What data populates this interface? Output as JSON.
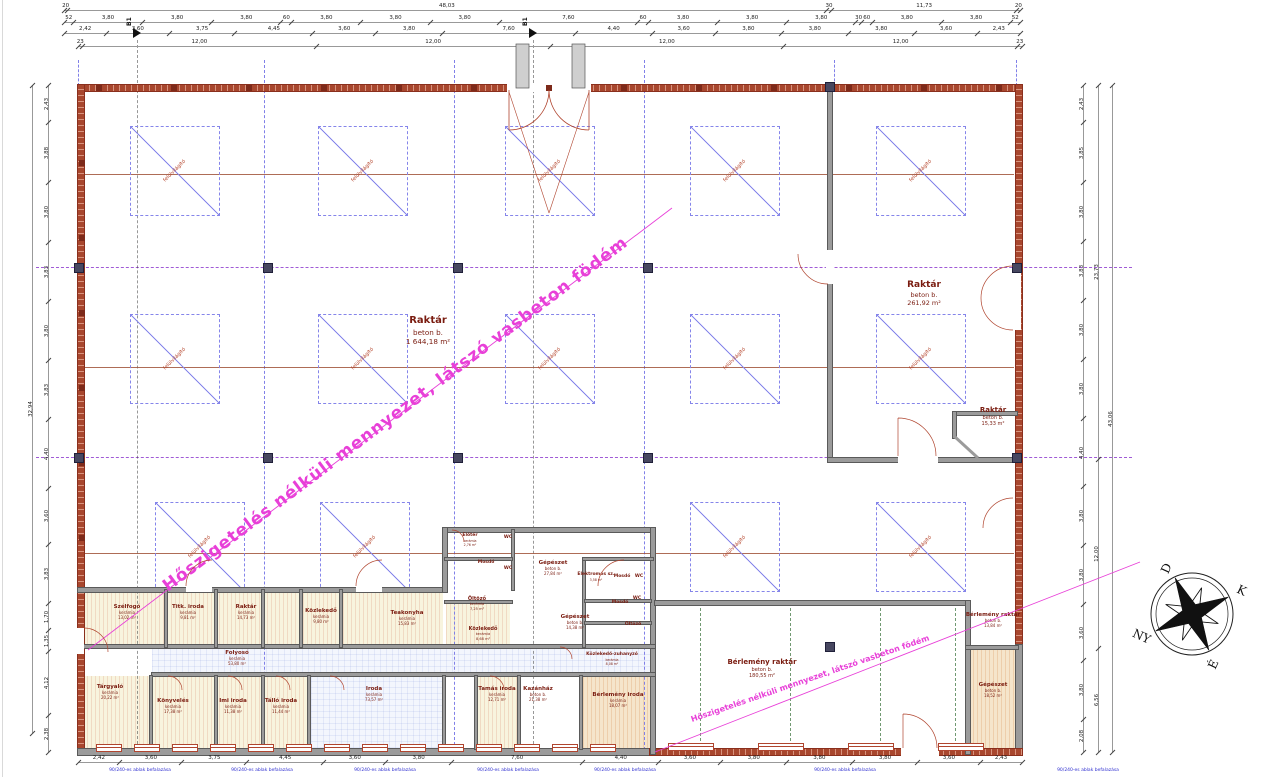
{
  "colors": {
    "wall_red": "#a8472e",
    "wall_gray": "#9b9b9b",
    "grid_blue": "#8080e8",
    "axis_purple": "#a05ad6",
    "beam_brown": "#a05238",
    "magenta_note": "#e83fd8",
    "room_label": "#7a1c10",
    "skylight_red": "#b5452c",
    "annotation_blue": "#2f2fd0"
  },
  "notes": {
    "ceiling_note": "Hőszigetelés nélküli mennyezet, látszó vasbeton födém",
    "ceiling_note_secondary": "Hőszigetelés nélküli mennyezet, látszó vasbeton födém"
  },
  "skylight_label": "felülvilágító",
  "section_markers": [
    "B1",
    "B1"
  ],
  "compass": {
    "d": "D",
    "k": "K",
    "e": "É",
    "ny": "NY"
  },
  "annotations": {
    "window_note": "90/240-es ablak befalazása"
  },
  "rooms": [
    {
      "n": "Raktár",
      "m": "beton b.",
      "a": "1 644,18 m²",
      "x": 428,
      "y": 315,
      "fs": 10
    },
    {
      "n": "Raktár",
      "m": "beton b.",
      "a": "261,92 m²",
      "x": 924,
      "y": 280,
      "fs": 9
    },
    {
      "n": "Raktár",
      "m": "beton b.",
      "a": "15,33 m²",
      "x": 993,
      "y": 406,
      "fs": 7
    },
    {
      "n": "Bérlemény raktár",
      "m": "beton b.",
      "a": "180,55 m²",
      "x": 762,
      "y": 658,
      "fs": 7
    },
    {
      "n": "Bérlemény raktár",
      "m": "beton b.",
      "a": "13,84 m²",
      "x": 993,
      "y": 612,
      "fs": 5.5
    },
    {
      "n": "Gépészet",
      "m": "beton b.",
      "a": "18,52 m²",
      "x": 993,
      "y": 682,
      "fs": 5.5
    },
    {
      "n": "Szélfogó",
      "m": "kerámia",
      "a": "13,02 m²",
      "x": 127,
      "y": 604,
      "fs": 5.5
    },
    {
      "n": "Titk. iroda",
      "m": "kerámia",
      "a": "9,81 m²",
      "x": 188,
      "y": 604,
      "fs": 5.5
    },
    {
      "n": "Raktár",
      "m": "kerámia",
      "a": "14,73 m²",
      "x": 246,
      "y": 604,
      "fs": 5.5
    },
    {
      "n": "Közlekedő",
      "m": "kerámia",
      "a": "9,80 m²",
      "x": 321,
      "y": 608,
      "fs": 5.5
    },
    {
      "n": "Teakonyha",
      "m": "kerámia",
      "a": "15,83 m²",
      "x": 407,
      "y": 610,
      "fs": 5.5
    },
    {
      "n": "Közlekedő",
      "m": "kerámia",
      "a": "8,68 m²",
      "x": 483,
      "y": 626,
      "fs": 5
    },
    {
      "n": "Gépészet",
      "m": "beton b.",
      "a": "27,84 m²",
      "x": 553,
      "y": 560,
      "fs": 5.5
    },
    {
      "n": "Elektromos sz.",
      "m": "",
      "a": "3,58 m²",
      "x": 596,
      "y": 572,
      "fs": 4.5
    },
    {
      "n": "Előtér",
      "m": "kerámia",
      "a": "2,76 m²",
      "x": 470,
      "y": 533,
      "fs": 4.5
    },
    {
      "n": "WC",
      "m": "",
      "a": "",
      "x": 508,
      "y": 535,
      "fs": 4.5
    },
    {
      "n": "Mosdó",
      "m": "",
      "a": "",
      "x": 486,
      "y": 560,
      "fs": 4.5
    },
    {
      "n": "WC",
      "m": "",
      "a": "",
      "x": 508,
      "y": 566,
      "fs": 4.5
    },
    {
      "n": "Öltöző",
      "m": "kerámia",
      "a": "7,25 m²",
      "x": 477,
      "y": 596,
      "fs": 5
    },
    {
      "n": "Mosdó",
      "m": "",
      "a": "",
      "x": 622,
      "y": 574,
      "fs": 4.5
    },
    {
      "n": "WC",
      "m": "",
      "a": "",
      "x": 639,
      "y": 574,
      "fs": 4.5
    },
    {
      "n": "Mosdó",
      "m": "",
      "a": "",
      "x": 620,
      "y": 600,
      "fs": 4.5
    },
    {
      "n": "WC",
      "m": "",
      "a": "",
      "x": 637,
      "y": 596,
      "fs": 4.5
    },
    {
      "n": "Öltöző",
      "m": "",
      "a": "",
      "x": 633,
      "y": 622,
      "fs": 4.5
    },
    {
      "n": "Gépészet",
      "m": "beton b.",
      "a": "14,38 m²",
      "x": 575,
      "y": 614,
      "fs": 5.5
    },
    {
      "n": "Folyosó",
      "m": "kerámia",
      "a": "53,80 m²",
      "x": 237,
      "y": 650,
      "fs": 5.5
    },
    {
      "n": "Tárgyaló",
      "m": "kerámia",
      "a": "20,22 m²",
      "x": 110,
      "y": 684,
      "fs": 5.5
    },
    {
      "n": "Könyvelés",
      "m": "kerámia",
      "a": "17,38 m²",
      "x": 173,
      "y": 698,
      "fs": 5.5
    },
    {
      "n": "Imi iroda",
      "m": "kerámia",
      "a": "11,38 m²",
      "x": 233,
      "y": 698,
      "fs": 5.5
    },
    {
      "n": "Tálló iroda",
      "m": "kerámia",
      "a": "11,44 m²",
      "x": 281,
      "y": 698,
      "fs": 5.5
    },
    {
      "n": "Iroda",
      "m": "kerámia",
      "a": "73,57 m²",
      "x": 374,
      "y": 686,
      "fs": 5.5
    },
    {
      "n": "Tamás iroda",
      "m": "kerámia",
      "a": "12,71 m²",
      "x": 497,
      "y": 686,
      "fs": 5.5
    },
    {
      "n": "Kazánház",
      "m": "beton b.",
      "a": "21,38 m²",
      "x": 538,
      "y": 686,
      "fs": 5.5
    },
    {
      "n": "Közlekedő-zuhanyzó",
      "m": "kerámia",
      "a": "8,08 m²",
      "x": 612,
      "y": 652,
      "fs": 4.5
    },
    {
      "n": "Bérlemény iroda",
      "m": "kerámia",
      "a": "18,07 m²",
      "x": 618,
      "y": 692,
      "fs": 5.5
    }
  ],
  "dimensions": {
    "top_total": [
      "20",
      "48,03",
      "30",
      "11,73",
      "20"
    ],
    "top_detail": [
      "52",
      "3,80",
      "3,80",
      "3,80",
      "60",
      "3,80",
      "3,80",
      "3,80",
      "7,60",
      "60",
      "3,80",
      "3,80",
      "3,80",
      "30",
      "60",
      "3,80",
      "3,80",
      "52"
    ],
    "top_inner": [
      "2,42",
      "3,60",
      "3,75",
      "4,45",
      "3,60",
      "3,80",
      "7,60",
      "4,40",
      "3,60",
      "3,80",
      "3,80",
      "3,80",
      "3,60",
      "2,43"
    ],
    "top_axes": [
      "23",
      "12,00",
      "12,00",
      "12,00",
      "12,00",
      "23"
    ],
    "left_outer": [
      "32,94"
    ],
    "left_detail": [
      "2,43",
      "3,88",
      "3,80",
      "3,83",
      "3,80",
      "3,83",
      "4,40",
      "3,60",
      "3,83",
      "1,70",
      "1,35",
      "4,12",
      "2,38"
    ],
    "right_detail": [
      "2,43",
      "3,85",
      "3,80",
      "3,83",
      "3,80",
      "3,80",
      "4,40",
      "3,80",
      "3,80",
      "3,60",
      "3,80",
      "2,08"
    ],
    "right_mid": [
      "23,73",
      "12,00",
      "6,56"
    ],
    "right_total": [
      "43,06"
    ],
    "bottom": [
      "2,42",
      "3,60",
      "3,75",
      "4,45",
      "3,60",
      "3,80",
      "7,60",
      "4,40",
      "3,60",
      "3,80",
      "3,80",
      "3,80",
      "3,60",
      "2,43"
    ]
  }
}
